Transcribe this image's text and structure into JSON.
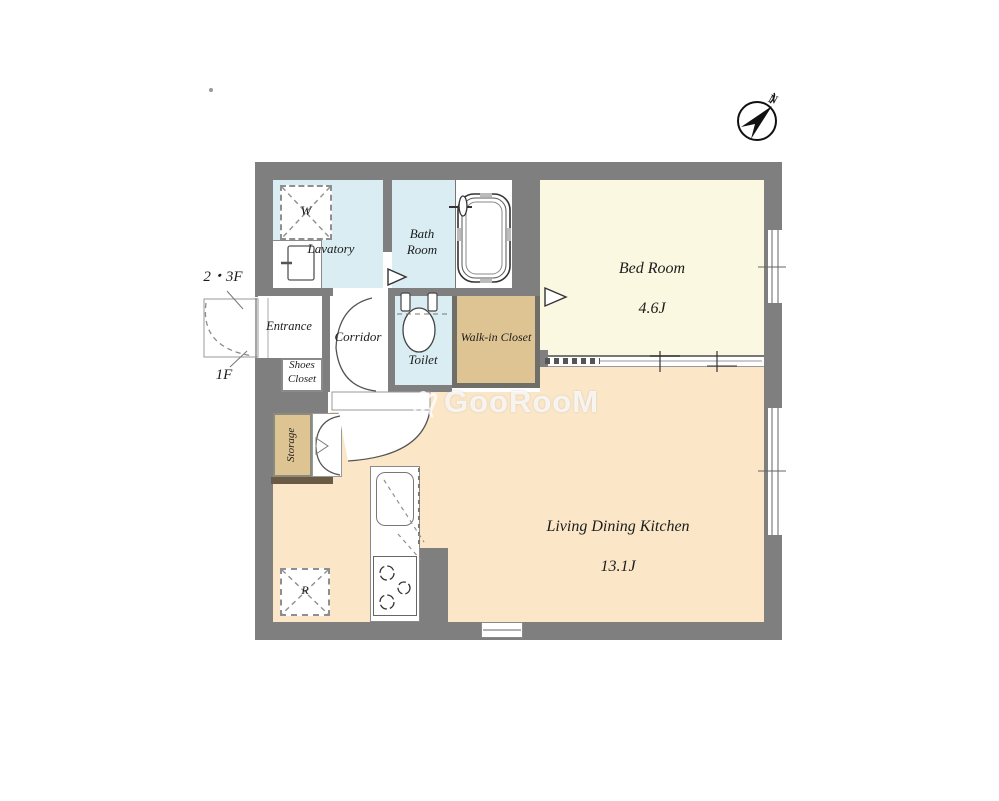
{
  "rooms": {
    "bedroom": {
      "name": "Bed Room",
      "size": "4.6J"
    },
    "ldk": {
      "name": "Living Dining Kitchen",
      "size": "13.1J"
    },
    "lavatory": {
      "name": "Lavatory"
    },
    "bathroom": {
      "name": "Bath Room"
    },
    "toilet": {
      "name": "Toilet"
    },
    "wic": {
      "name": "Walk-in Closet"
    },
    "entrance": {
      "name": "Entrance"
    },
    "corridor": {
      "name": "Corridor"
    },
    "shoes_closet": {
      "name": "Shoes Closet"
    },
    "storage": {
      "name": "Storage"
    }
  },
  "fixtures": {
    "washing_machine": "W",
    "refrigerator": "R"
  },
  "annotations": {
    "upper_floors": "2・3F",
    "first_floor": "1F",
    "compass_north": "N"
  },
  "watermark": {
    "text": "GooRooM"
  },
  "colors": {
    "wall": "#7f7f7f",
    "water": "#d9edf2",
    "closet": "#dfc493",
    "bedroom": "#faf8e1",
    "ldk": "#fbe7c8",
    "shelf": "#6b5b45",
    "wic_border": "#6f6e69"
  }
}
